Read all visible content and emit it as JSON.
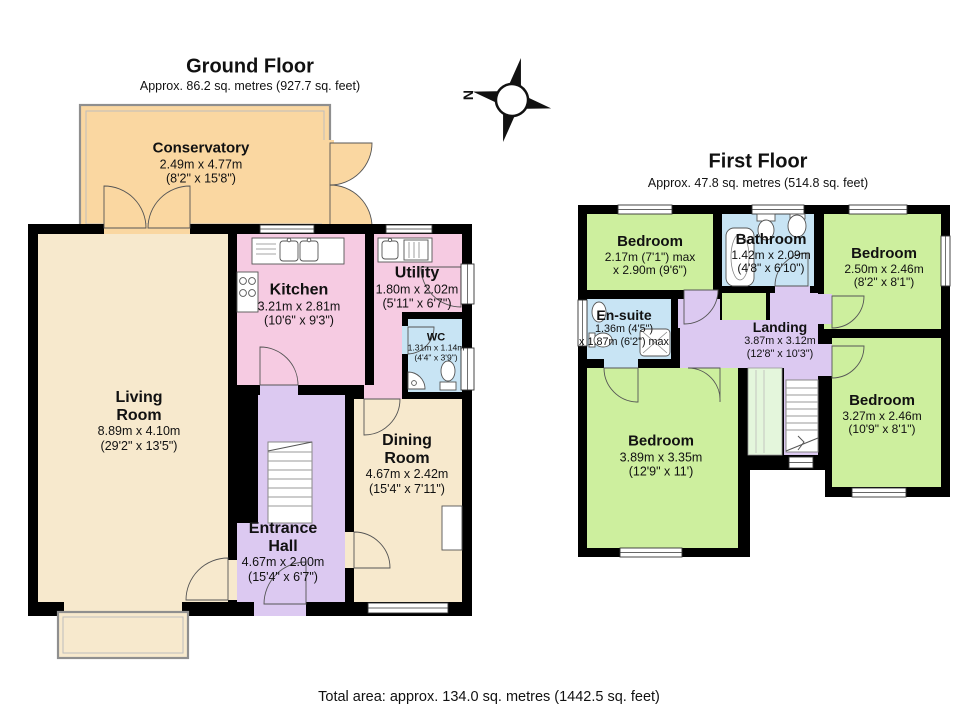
{
  "ground_floor": {
    "title": "Ground Floor",
    "subtitle": "Approx. 86.2 sq. metres (927.7 sq. feet)",
    "rooms": {
      "conservatory": {
        "name": "Conservatory",
        "dims_m": "2.49m x 4.77m",
        "dims_ft": "(8'2\" x 15'8\")"
      },
      "kitchen": {
        "name": "Kitchen",
        "dims_m": "3.21m x 2.81m",
        "dims_ft": "(10'6\" x 9'3\")"
      },
      "utility": {
        "name": "Utility",
        "dims_m": "1.80m x 2.02m",
        "dims_ft": "(5'11\" x 6'7\")"
      },
      "wc": {
        "name": "WC",
        "dims_m": "1.31m x 1.14m",
        "dims_ft": "(4'4\" x 3'9\")"
      },
      "living_room": {
        "name": "Living Room",
        "dims_m": "8.89m x 4.10m",
        "dims_ft": "(29'2\" x 13'5\")"
      },
      "dining_room": {
        "name": "Dining Room",
        "dims_m": "4.67m x 2.42m",
        "dims_ft": "(15'4\" x 7'11\")"
      },
      "entrance_hall": {
        "name": "Entrance Hall",
        "dims_m": "4.67m x 2.00m",
        "dims_ft": "(15'4\" x 6'7\")"
      }
    }
  },
  "first_floor": {
    "title": "First Floor",
    "subtitle": "Approx. 47.8 sq. metres (514.8 sq. feet)",
    "rooms": {
      "bedroom_1": {
        "name": "Bedroom",
        "dims_m": "2.17m (7'1\") max",
        "dims_ft": "x 2.90m (9'6\")"
      },
      "bathroom": {
        "name": "Bathroom",
        "dims_m": "1.42m x 2.09m",
        "dims_ft": "(4'8\" x 6'10\")"
      },
      "bedroom_2": {
        "name": "Bedroom",
        "dims_m": "2.50m x 2.46m",
        "dims_ft": "(8'2\" x 8'1\")"
      },
      "en_suite": {
        "name": "En-suite",
        "dims_m": "1.36m (4'5\")",
        "dims_ft": "x 1.87m (6'2\") max"
      },
      "landing": {
        "name": "Landing",
        "dims_m": "3.87m x 3.12m",
        "dims_ft": "(12'8\" x 10'3\")"
      },
      "bedroom_3": {
        "name": "Bedroom",
        "dims_m": "3.89m x 3.35m",
        "dims_ft": "(12'9\" x 11')"
      },
      "bedroom_4": {
        "name": "Bedroom",
        "dims_m": "3.27m x 2.46m",
        "dims_ft": "(10'9\" x 8'1\")"
      }
    }
  },
  "compass": {
    "north": "N"
  },
  "footer": {
    "total_area": "Total area: approx. 134.0 sq. metres (1442.5 sq. feet)"
  },
  "colors": {
    "wall": "#000000",
    "cream": "#F7E9CD",
    "orange": "#FAD7A1",
    "pink": "#F6CBE2",
    "blue": "#C8E4F4",
    "purple": "#DCC9F1",
    "green": "#CDEF9E",
    "palegreen": "#E4F6DC"
  }
}
